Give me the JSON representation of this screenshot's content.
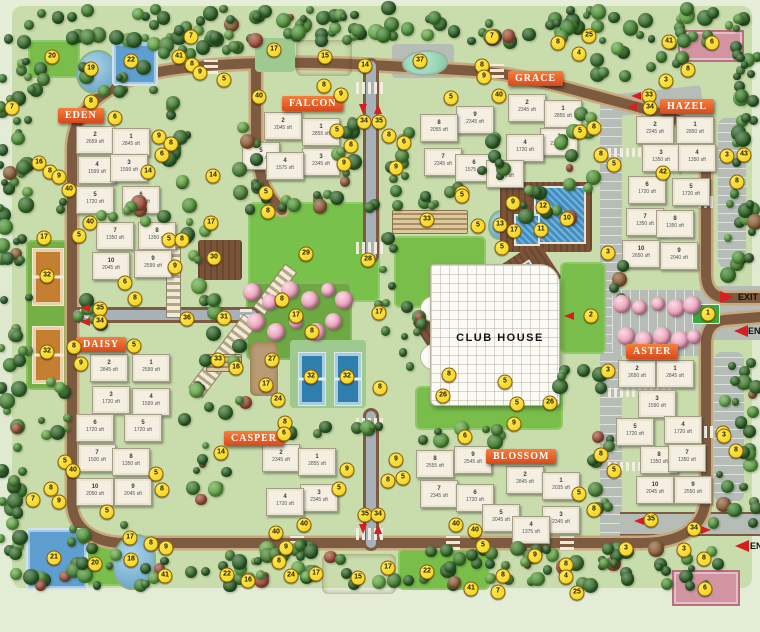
{
  "club_house": {
    "label": "CLUB HOUSE",
    "x": 440,
    "y": 332
  },
  "gates": [
    {
      "label": "EXIT",
      "tx": 738,
      "ty": 297,
      "ax": 727,
      "ay": 297,
      "dir": "right"
    },
    {
      "label": "ENTRY",
      "tx": 748,
      "ty": 331,
      "ax": 741,
      "ay": 331,
      "dir": "left"
    },
    {
      "label": "ENTRY",
      "tx": 750,
      "ty": 546,
      "ax": 742,
      "ay": 546,
      "dir": "left"
    }
  ],
  "road_arrows": [
    {
      "dir": "down",
      "x": 363,
      "y": 109
    },
    {
      "dir": "up",
      "x": 378,
      "y": 109
    },
    {
      "dir": "left",
      "x": 85,
      "y": 308
    },
    {
      "dir": "left",
      "x": 85,
      "y": 322
    },
    {
      "dir": "down",
      "x": 363,
      "y": 529
    },
    {
      "dir": "up",
      "x": 378,
      "y": 529
    },
    {
      "dir": "left",
      "x": 636,
      "y": 96
    },
    {
      "dir": "left",
      "x": 632,
      "y": 107
    },
    {
      "dir": "left",
      "x": 639,
      "y": 521
    },
    {
      "dir": "right",
      "x": 706,
      "y": 530
    },
    {
      "dir": "left",
      "x": 569,
      "y": 316
    }
  ],
  "clusters": [
    {
      "name": "EDEN",
      "banner": {
        "x": 58,
        "y": 108
      },
      "buildings": [
        {
          "no": "2",
          "area": "2659 sft",
          "x": 76,
          "y": 126
        },
        {
          "no": "1",
          "area": "2845 sft",
          "x": 112,
          "y": 128
        },
        {
          "no": "4",
          "area": "1599 sft",
          "x": 78,
          "y": 156
        },
        {
          "no": "3",
          "area": "1599 sft",
          "x": 110,
          "y": 154
        },
        {
          "no": "5",
          "area": "1720 sft",
          "x": 76,
          "y": 186
        },
        {
          "no": "6",
          "area": "1720 sft",
          "x": 122,
          "y": 186
        },
        {
          "no": "7",
          "area": "1350 sft",
          "x": 96,
          "y": 222
        },
        {
          "no": "8",
          "area": "1350 sft",
          "x": 138,
          "y": 222
        },
        {
          "no": "10",
          "area": "2045 sft",
          "x": 92,
          "y": 252
        },
        {
          "no": "9",
          "area": "2599 sft",
          "x": 134,
          "y": 250
        }
      ]
    },
    {
      "name": "FALCON",
      "banner": {
        "x": 282,
        "y": 96
      },
      "buildings": [
        {
          "no": "2",
          "area": "2045 sft",
          "x": 264,
          "y": 112
        },
        {
          "no": "1",
          "area": "2855 sft",
          "x": 302,
          "y": 118
        },
        {
          "no": "5",
          "area": "2045 sft",
          "x": 242,
          "y": 142
        },
        {
          "no": "3",
          "area": "2345 sft",
          "x": 302,
          "y": 148
        },
        {
          "no": "4",
          "area": "1575 sft",
          "x": 266,
          "y": 152
        }
      ]
    },
    {
      "name": "GRACE",
      "banner": {
        "x": 508,
        "y": 71
      },
      "buildings": [
        {
          "no": "2",
          "area": "2345 sft",
          "x": 508,
          "y": 94
        },
        {
          "no": "1",
          "area": "2855 sft",
          "x": 544,
          "y": 100
        },
        {
          "no": "9",
          "area": "2345 sft",
          "x": 456,
          "y": 106
        },
        {
          "no": "8",
          "area": "2055 sft",
          "x": 420,
          "y": 114
        },
        {
          "no": "3",
          "area": "2345 sft",
          "x": 540,
          "y": 128
        },
        {
          "no": "4",
          "area": "1720 sft",
          "x": 506,
          "y": 134
        },
        {
          "no": "7",
          "area": "2345 sft",
          "x": 424,
          "y": 148
        },
        {
          "no": "6",
          "area": "1575 sft",
          "x": 455,
          "y": 154
        },
        {
          "no": "5",
          "area": "2045 sft",
          "x": 486,
          "y": 160
        }
      ]
    },
    {
      "name": "HAZEL",
      "banner": {
        "x": 660,
        "y": 99
      },
      "buildings": [
        {
          "no": "2",
          "area": "2245 sft",
          "x": 636,
          "y": 116
        },
        {
          "no": "1",
          "area": "2850 sft",
          "x": 676,
          "y": 116
        },
        {
          "no": "3",
          "area": "1350 sft",
          "x": 642,
          "y": 144
        },
        {
          "no": "4",
          "area": "1350 sft",
          "x": 678,
          "y": 144
        },
        {
          "no": "6",
          "area": "1720 sft",
          "x": 628,
          "y": 176
        },
        {
          "no": "5",
          "area": "1720 sft",
          "x": 672,
          "y": 178
        },
        {
          "no": "7",
          "area": "1350 sft",
          "x": 626,
          "y": 208
        },
        {
          "no": "8",
          "area": "1350 sft",
          "x": 656,
          "y": 210
        },
        {
          "no": "10",
          "area": "2650 sft",
          "x": 622,
          "y": 240
        },
        {
          "no": "9",
          "area": "2040 sft",
          "x": 660,
          "y": 242
        }
      ]
    },
    {
      "name": "DAISY",
      "banner": {
        "x": 76,
        "y": 337
      },
      "buildings": [
        {
          "no": "2",
          "area": "2845 sft",
          "x": 90,
          "y": 354
        },
        {
          "no": "1",
          "area": "2599 sft",
          "x": 132,
          "y": 354
        },
        {
          "no": "3",
          "area": "1720 sft",
          "x": 92,
          "y": 386
        },
        {
          "no": "4",
          "area": "1599 sft",
          "x": 132,
          "y": 388
        },
        {
          "no": "6",
          "area": "1720 sft",
          "x": 76,
          "y": 414
        },
        {
          "no": "5",
          "area": "1720 sft",
          "x": 124,
          "y": 414
        },
        {
          "no": "7",
          "area": "1500 sft",
          "x": 78,
          "y": 444
        },
        {
          "no": "8",
          "area": "1350 sft",
          "x": 112,
          "y": 448
        },
        {
          "no": "10",
          "area": "2050 sft",
          "x": 76,
          "y": 478
        },
        {
          "no": "9",
          "area": "2045 sft",
          "x": 114,
          "y": 478
        }
      ]
    },
    {
      "name": "CASPER",
      "banner": {
        "x": 224,
        "y": 431
      },
      "buildings": [
        {
          "no": "2",
          "area": "2345 sft",
          "x": 262,
          "y": 444
        },
        {
          "no": "1",
          "area": "2855 sft",
          "x": 298,
          "y": 448
        },
        {
          "no": "3",
          "area": "2345 sft",
          "x": 300,
          "y": 484
        },
        {
          "no": "4",
          "area": "1720 sft",
          "x": 266,
          "y": 488
        }
      ]
    },
    {
      "name": "BLOSSOM",
      "banner": {
        "x": 486,
        "y": 449
      },
      "buildings": [
        {
          "no": "8",
          "area": "2555 sft",
          "x": 416,
          "y": 450
        },
        {
          "no": "9",
          "area": "2545 sft",
          "x": 454,
          "y": 446
        },
        {
          "no": "7",
          "area": "2345 sft",
          "x": 420,
          "y": 480
        },
        {
          "no": "6",
          "area": "1720 sft",
          "x": 456,
          "y": 484
        },
        {
          "no": "2",
          "area": "2845 sft",
          "x": 506,
          "y": 466
        },
        {
          "no": "1",
          "area": "2035 sft",
          "x": 542,
          "y": 472
        },
        {
          "no": "5",
          "area": "2045 sft",
          "x": 482,
          "y": 504
        },
        {
          "no": "3",
          "area": "2345 sft",
          "x": 542,
          "y": 506
        },
        {
          "no": "4",
          "area": "1375 sft",
          "x": 512,
          "y": 516
        }
      ]
    },
    {
      "name": "ASTER",
      "banner": {
        "x": 626,
        "y": 344
      },
      "buildings": [
        {
          "no": "2",
          "area": "2650 sft",
          "x": 618,
          "y": 360
        },
        {
          "no": "1",
          "area": "2845 sft",
          "x": 656,
          "y": 360
        },
        {
          "no": "3",
          "area": "1590 sft",
          "x": 638,
          "y": 390
        },
        {
          "no": "5",
          "area": "1720 sft",
          "x": 616,
          "y": 418
        },
        {
          "no": "4",
          "area": "1720 sft",
          "x": 664,
          "y": 416
        },
        {
          "no": "8",
          "area": "1350 sft",
          "x": 640,
          "y": 446
        },
        {
          "no": "7",
          "area": "1350 sft",
          "x": 668,
          "y": 444
        },
        {
          "no": "10",
          "area": "2045 sft",
          "x": 636,
          "y": 476
        },
        {
          "no": "9",
          "area": "2550 sft",
          "x": 674,
          "y": 476
        }
      ]
    }
  ],
  "markers_nxy": [
    [
      "7",
      191,
      37
    ],
    [
      "20",
      52,
      57
    ],
    [
      "19",
      91,
      69
    ],
    [
      "22",
      131,
      61
    ],
    [
      "41",
      179,
      57
    ],
    [
      "8",
      192,
      65
    ],
    [
      "9",
      200,
      73
    ],
    [
      "5",
      224,
      80
    ],
    [
      "7",
      12,
      108
    ],
    [
      "8",
      91,
      102
    ],
    [
      "6",
      115,
      118
    ],
    [
      "16",
      39,
      163
    ],
    [
      "8",
      50,
      172
    ],
    [
      "9",
      59,
      177
    ],
    [
      "9",
      159,
      137
    ],
    [
      "8",
      171,
      144
    ],
    [
      "6",
      162,
      155
    ],
    [
      "14",
      148,
      172
    ],
    [
      "14",
      213,
      176
    ],
    [
      "40",
      69,
      190
    ],
    [
      "17",
      274,
      50
    ],
    [
      "15",
      325,
      57
    ],
    [
      "14",
      365,
      66
    ],
    [
      "37",
      420,
      61
    ],
    [
      "7",
      492,
      37
    ],
    [
      "8",
      482,
      66
    ],
    [
      "9",
      484,
      77
    ],
    [
      "40",
      259,
      97
    ],
    [
      "40",
      499,
      96
    ],
    [
      "8",
      324,
      86
    ],
    [
      "9",
      341,
      95
    ],
    [
      "34",
      364,
      122
    ],
    [
      "35",
      379,
      122
    ],
    [
      "5",
      337,
      131
    ],
    [
      "8",
      351,
      146
    ],
    [
      "9",
      344,
      164
    ],
    [
      "8",
      389,
      136
    ],
    [
      "6",
      404,
      143
    ],
    [
      "9",
      396,
      168
    ],
    [
      "5",
      451,
      98
    ],
    [
      "5",
      462,
      193
    ],
    [
      "5",
      266,
      193
    ],
    [
      "25",
      589,
      36
    ],
    [
      "8",
      558,
      43
    ],
    [
      "4",
      579,
      54
    ],
    [
      "41",
      669,
      42
    ],
    [
      "6",
      712,
      43
    ],
    [
      "8",
      688,
      70
    ],
    [
      "3",
      666,
      81
    ],
    [
      "33",
      649,
      96
    ],
    [
      "34",
      650,
      108
    ],
    [
      "5",
      580,
      132
    ],
    [
      "8",
      594,
      128
    ],
    [
      "8",
      601,
      155
    ],
    [
      "5",
      614,
      165
    ],
    [
      "42",
      663,
      173
    ],
    [
      "3",
      727,
      156
    ],
    [
      "43",
      744,
      155
    ],
    [
      "8",
      737,
      182
    ],
    [
      "8",
      268,
      212
    ],
    [
      "29",
      306,
      254
    ],
    [
      "28",
      368,
      260
    ],
    [
      "33",
      427,
      220
    ],
    [
      "5",
      462,
      196
    ],
    [
      "5",
      478,
      226
    ],
    [
      "13",
      500,
      225
    ],
    [
      "17",
      514,
      231
    ],
    [
      "9",
      513,
      203
    ],
    [
      "12",
      543,
      207
    ],
    [
      "10",
      567,
      219
    ],
    [
      "11",
      541,
      230
    ],
    [
      "5",
      502,
      248
    ],
    [
      "17",
      296,
      316
    ],
    [
      "17",
      379,
      313
    ],
    [
      "8",
      282,
      300
    ],
    [
      "8",
      312,
      332
    ],
    [
      "27",
      272,
      360
    ],
    [
      "17",
      266,
      385
    ],
    [
      "24",
      278,
      400
    ],
    [
      "32",
      311,
      377
    ],
    [
      "32",
      347,
      377
    ],
    [
      "8",
      380,
      388
    ],
    [
      "36",
      187,
      319
    ],
    [
      "16",
      236,
      368
    ],
    [
      "17",
      211,
      223
    ],
    [
      "30",
      214,
      258
    ],
    [
      "31",
      224,
      318
    ],
    [
      "33",
      218,
      360
    ],
    [
      "8",
      449,
      375
    ],
    [
      "26",
      443,
      396
    ],
    [
      "26",
      550,
      403
    ],
    [
      "5",
      505,
      382
    ],
    [
      "5",
      517,
      404
    ],
    [
      "2",
      591,
      316
    ],
    [
      "3",
      608,
      253
    ],
    [
      "3",
      608,
      371
    ],
    [
      "1",
      708,
      314
    ],
    [
      "3",
      723,
      433
    ],
    [
      "35",
      100,
      309
    ],
    [
      "34",
      100,
      322
    ],
    [
      "17",
      44,
      238
    ],
    [
      "40",
      90,
      223
    ],
    [
      "5",
      79,
      236
    ],
    [
      "32",
      47,
      276
    ],
    [
      "32",
      47,
      352
    ],
    [
      "5",
      169,
      240
    ],
    [
      "8",
      182,
      240
    ],
    [
      "9",
      175,
      267
    ],
    [
      "6",
      125,
      283
    ],
    [
      "8",
      135,
      299
    ],
    [
      "8",
      74,
      347
    ],
    [
      "5",
      134,
      346
    ],
    [
      "9",
      81,
      364
    ],
    [
      "5",
      65,
      462
    ],
    [
      "40",
      73,
      471
    ],
    [
      "8",
      51,
      489
    ],
    [
      "7",
      33,
      500
    ],
    [
      "9",
      59,
      502
    ],
    [
      "5",
      107,
      512
    ],
    [
      "5",
      156,
      474
    ],
    [
      "8",
      162,
      490
    ],
    [
      "17",
      130,
      538
    ],
    [
      "8",
      151,
      544
    ],
    [
      "9",
      166,
      548
    ],
    [
      "21",
      54,
      558
    ],
    [
      "20",
      95,
      564
    ],
    [
      "18",
      131,
      560
    ],
    [
      "41",
      165,
      576
    ],
    [
      "22",
      227,
      575
    ],
    [
      "16",
      248,
      581
    ],
    [
      "14",
      221,
      453
    ],
    [
      "8",
      285,
      423
    ],
    [
      "6",
      284,
      434
    ],
    [
      "9",
      347,
      470
    ],
    [
      "9",
      396,
      460
    ],
    [
      "8",
      388,
      481
    ],
    [
      "5",
      403,
      478
    ],
    [
      "6",
      465,
      437
    ],
    [
      "5",
      339,
      489
    ],
    [
      "35",
      365,
      515
    ],
    [
      "34",
      378,
      515
    ],
    [
      "40",
      304,
      525
    ],
    [
      "40",
      276,
      533
    ],
    [
      "40",
      456,
      525
    ],
    [
      "40",
      475,
      531
    ],
    [
      "5",
      483,
      546
    ],
    [
      "9",
      286,
      548
    ],
    [
      "8",
      279,
      562
    ],
    [
      "24",
      291,
      576
    ],
    [
      "17",
      316,
      574
    ],
    [
      "15",
      358,
      578
    ],
    [
      "17",
      388,
      568
    ],
    [
      "22",
      427,
      572
    ],
    [
      "41",
      471,
      589
    ],
    [
      "7",
      498,
      592
    ],
    [
      "8",
      503,
      576
    ],
    [
      "9",
      514,
      424
    ],
    [
      "8",
      601,
      455
    ],
    [
      "5",
      614,
      471
    ],
    [
      "5",
      579,
      494
    ],
    [
      "8",
      594,
      510
    ],
    [
      "3",
      724,
      436
    ],
    [
      "8",
      736,
      451
    ],
    [
      "35",
      651,
      520
    ],
    [
      "34",
      694,
      529
    ],
    [
      "3",
      684,
      550
    ],
    [
      "8",
      704,
      559
    ],
    [
      "3",
      626,
      549
    ],
    [
      "9",
      535,
      556
    ],
    [
      "8",
      566,
      565
    ],
    [
      "4",
      566,
      577
    ],
    [
      "25",
      577,
      593
    ],
    [
      "6",
      705,
      589
    ]
  ],
  "colors": {
    "banner": "#e05a22",
    "marker_fill": "#f2cf0e",
    "marker_border": "#8a5c08",
    "road": "#7d5b40",
    "road_casing": "#c8a97d",
    "asphalt": "#a7b2b8",
    "lawn": "#79bd4a",
    "pool": "#3f8fc4",
    "court_clay": "#c57f31",
    "court_blue": "#2e7fae",
    "court_pink": "#d294a0",
    "arrow_red": "#d61f1f"
  }
}
